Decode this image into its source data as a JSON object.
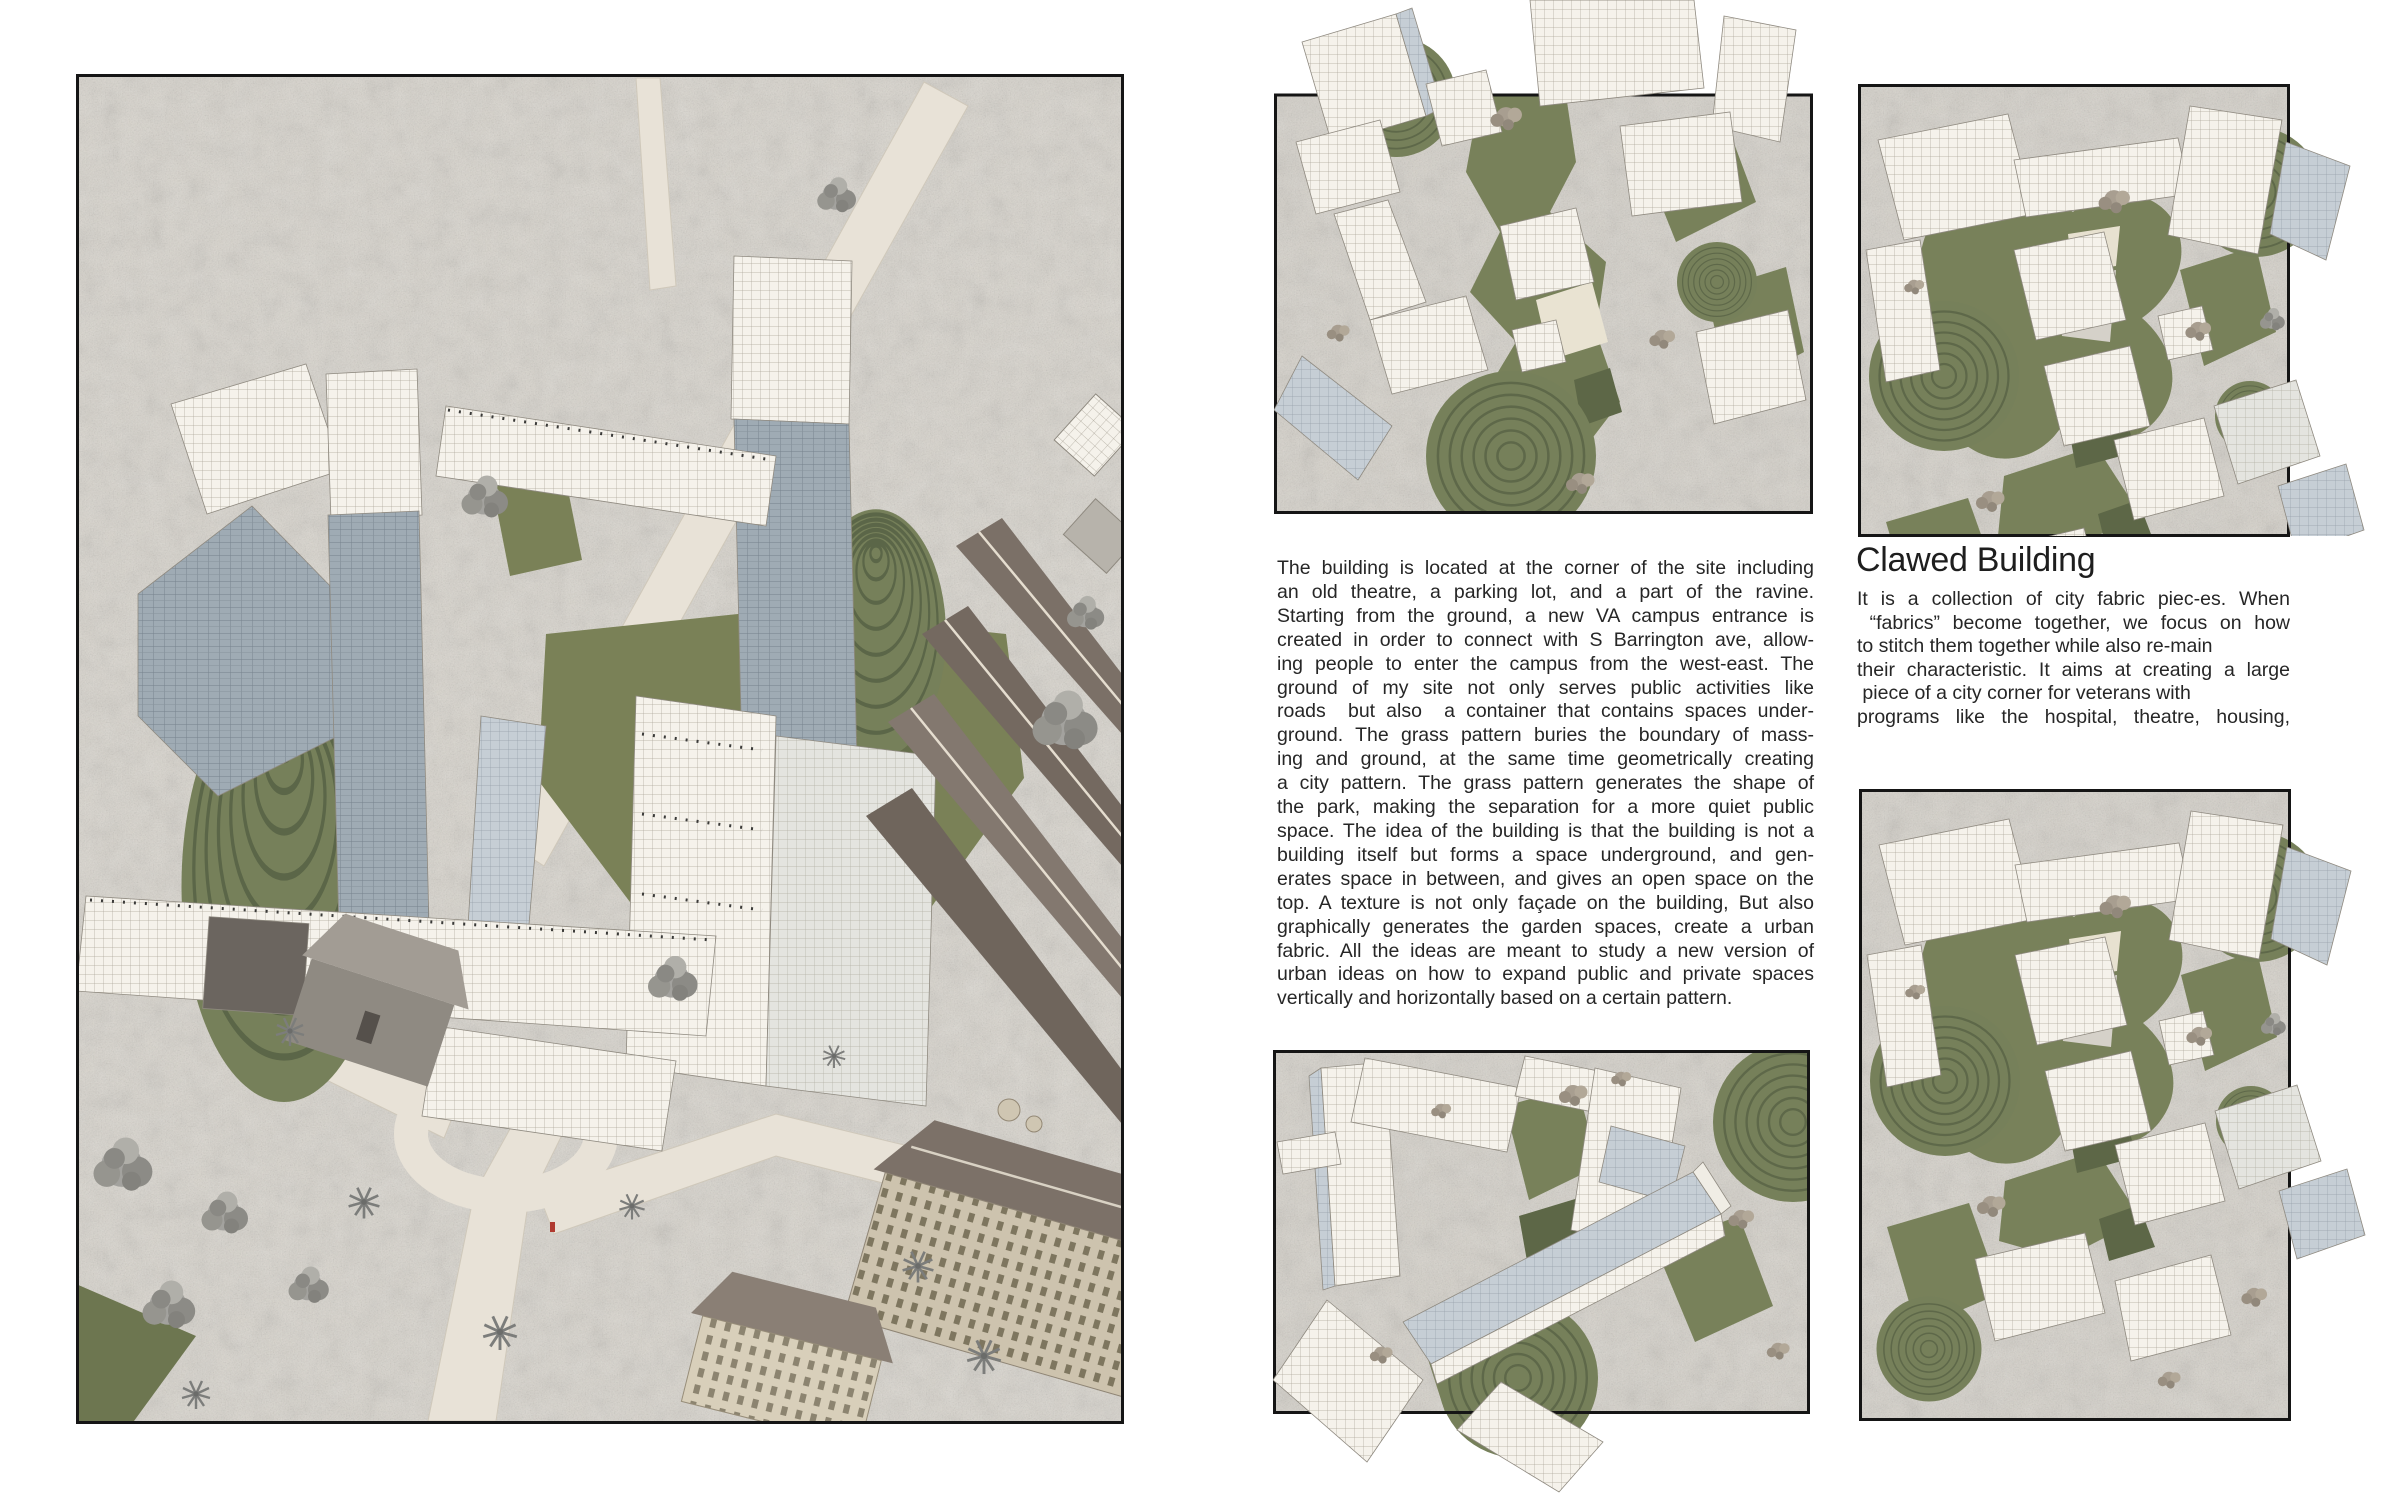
{
  "page": {
    "background": "#ffffff"
  },
  "palette": {
    "text": "#262626",
    "frame_border": "#151515",
    "ground": "#d7d3cb",
    "road": "#e8e2d7",
    "grass": "#78815a",
    "grass_dark": "#5d6747",
    "building_white": "#f5f2eb",
    "building_blue": "#c6ced5",
    "tower_glass": "#9fabb4",
    "roof_brown": "#7b7067",
    "wall_tan": "#cdc3ae",
    "tree_gray": "#9b9a96",
    "red_figure": "#b03a30"
  },
  "images": {
    "site": {
      "label": "aerial rendering of VA campus site with gridded buildings, grass cones and park"
    },
    "fabric_top": {
      "label": "urban fabric study rendering with white gridded blocks and grass pattern"
    },
    "claw_top": {
      "label": "clawed building rendering with gridded blocks around green claw-shaped garden"
    },
    "bars_bottom": {
      "label": "fabric bars rendering with long gridded slabs and terraced green cone"
    },
    "claw_bottom": {
      "label": "clawed building rendering, taller crop"
    }
  },
  "intro": {
    "lines": [
      "The building is located at the corner of the site including",
      "an old theatre, a parking lot, and a part of the ravine.",
      "Starting from the ground, a new VA campus entrance is",
      "created in order to connect with S Barrington ave, allow-",
      "ing people to enter the campus from the west-east. The",
      "ground of my site not only serves public activities like",
      "roads  but also  a container that contains spaces under-",
      "ground. The grass pattern buries the boundary of mass-",
      "ing and ground, at the same time geometrically creating",
      "a city pattern. The grass pattern generates the shape of",
      "the park, making the separation for a more quiet public",
      "space. The idea of the building is that the building is not a",
      "building itself but forms a space underground, and gen-",
      "erates space in between, and gives an open space on the",
      "top. A texture is not only façade on the building, But also",
      "graphically generates the garden spaces, create a urban",
      "fabric. All the ideas are meant to study a new version of",
      "urban ideas on how to expand public and private spaces",
      "vertically and horizontally based on a certain pattern."
    ]
  },
  "clawed": {
    "heading": "Clawed Building",
    "lines": [
      "It is a collection of city fabric piec-es. When",
      " “fabrics” become together, we focus on how",
      "to stitch them together while also re-main",
      "their characteristic. It aims at creating a large",
      " piece of a city corner for veterans with",
      "programs like the hospital, theatre, housing,"
    ]
  }
}
